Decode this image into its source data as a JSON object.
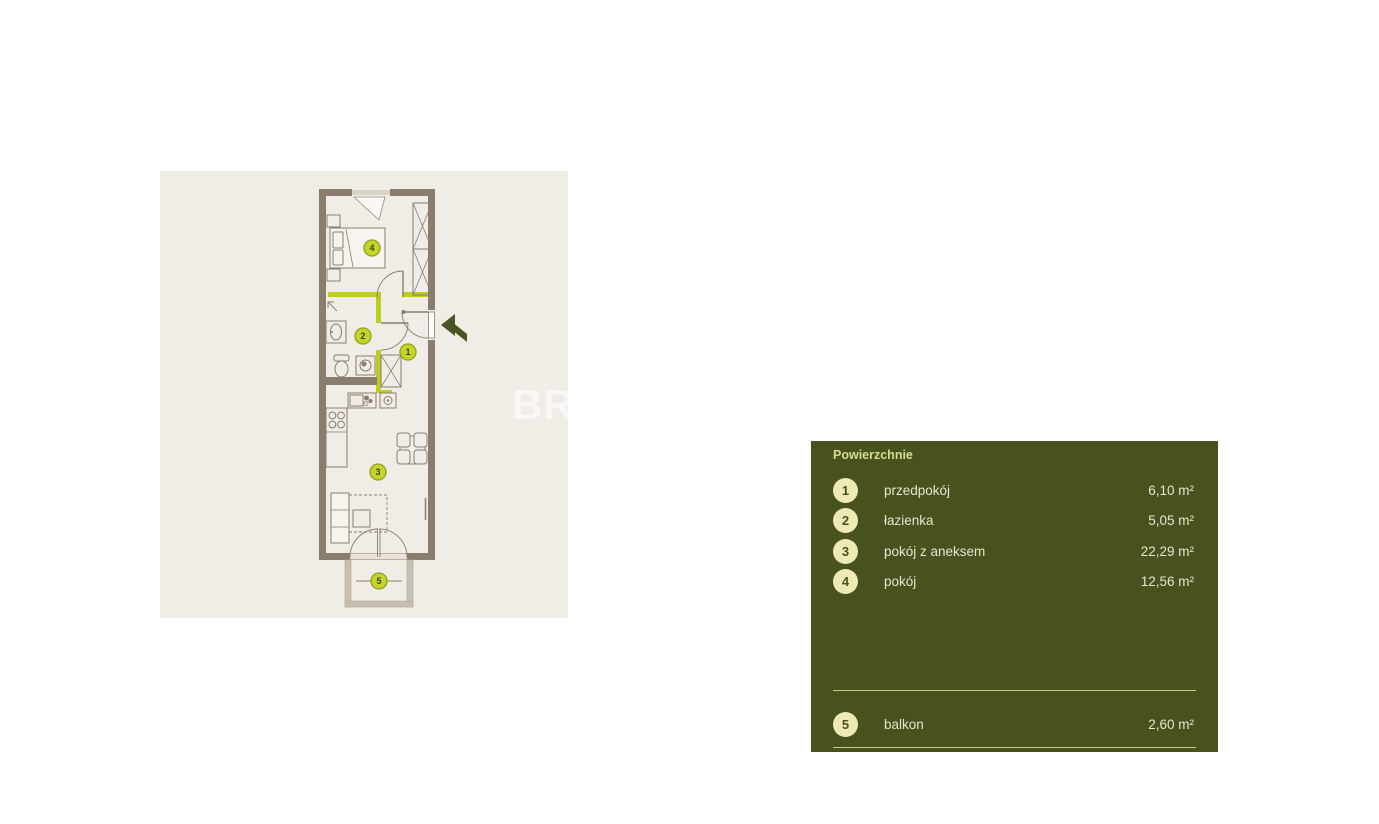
{
  "floorplan": {
    "watermark": "BR",
    "panel_bg": "#f0ece6",
    "wall_color": "#8a7c6e",
    "accent_wall_color": "#bdcd1d",
    "plan_badge_fill": "#c6d32a",
    "plan_badge_border": "#8fa01c",
    "plan_badge_text": "#3f4a19",
    "entrance_arrow_color": "#4a5424",
    "balcony_wall_color": "#c8bfb2"
  },
  "legend": {
    "title": "Powierzchnie",
    "panel_bg": "#47521e",
    "title_color": "#d8db8f",
    "text_color": "#e6e5ce",
    "badge_fill": "#edeab5",
    "divider_color": "#c9cc84",
    "rooms": [
      {
        "number": "1",
        "label": "przedpokój",
        "area": "6,10 m²"
      },
      {
        "number": "2",
        "label": "łazienka",
        "area": "5,05 m²"
      },
      {
        "number": "3",
        "label": "pokój z aneksem",
        "area": "22,29 m²"
      },
      {
        "number": "4",
        "label": "pokój",
        "area": "12,56 m²"
      }
    ],
    "outdoor": [
      {
        "number": "5",
        "label": "balkon",
        "area": "2,60 m²"
      }
    ]
  }
}
